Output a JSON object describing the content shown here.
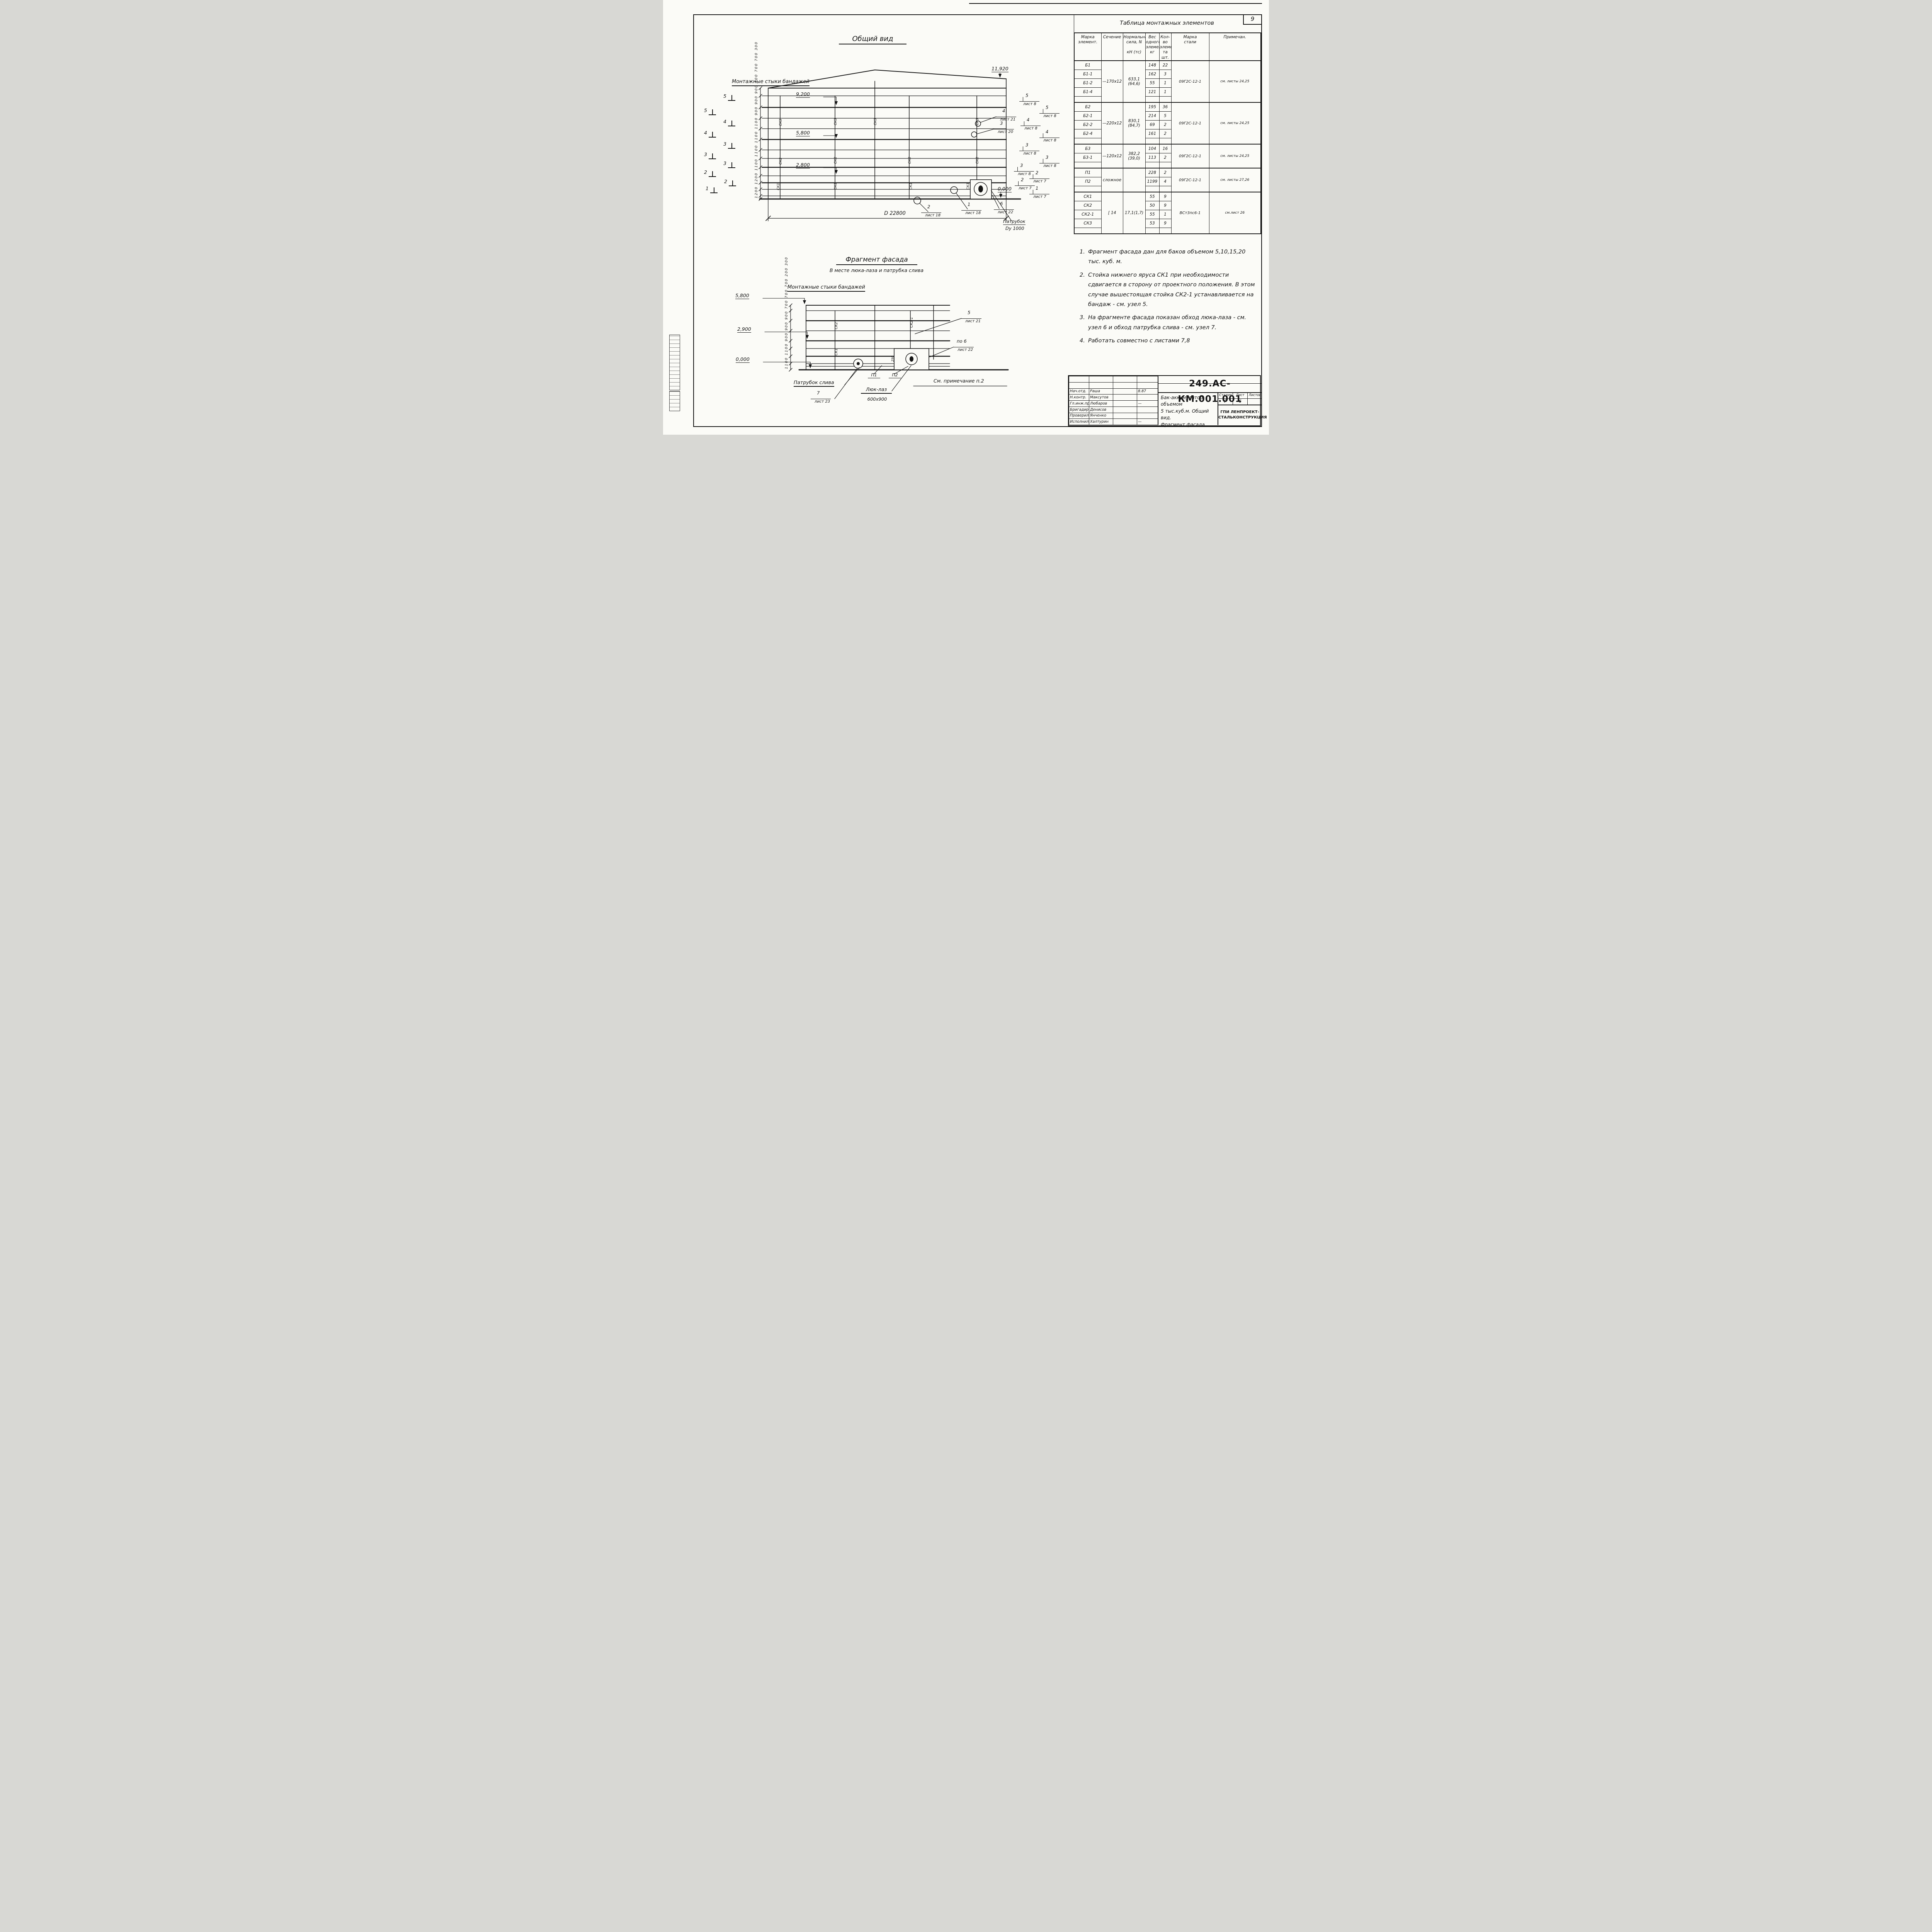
{
  "page": {
    "number": "9"
  },
  "gv": {
    "title": "Общий вид",
    "bandages": "Монтажные стыки бандажей",
    "elev_top": "11,920",
    "elev_9200": "9,200",
    "elev_5800": "5,800",
    "elev_2800": "2,800",
    "elev_0": "0,000",
    "dims_chain": "1200 1200 1100 1100 1100 1100 900 900 900 700 700 700 300",
    "sec_outer": [
      "5",
      "4",
      "3",
      "2",
      "1"
    ],
    "sec_inner": [
      "5",
      "4",
      "3",
      "3",
      "2"
    ],
    "right_marks": [
      {
        "num": "5",
        "sheet": "лист 8"
      },
      {
        "num": "5",
        "sheet": "лист 8"
      },
      {
        "num": "4",
        "sheet": "лист 8"
      },
      {
        "num": "4",
        "sheet": "лист 8"
      },
      {
        "num": "3",
        "sheet": "лист 8"
      },
      {
        "num": "3",
        "sheet": "лист 8"
      },
      {
        "num": "3",
        "sheet": "лист 8"
      },
      {
        "num": "2",
        "sheet": "лист 7"
      },
      {
        "num": "2",
        "sheet": "лист 7"
      },
      {
        "num": "1",
        "sheet": "лист 7"
      }
    ],
    "edge_callouts": [
      {
        "num": "4",
        "sheet": "лист 21"
      },
      {
        "num": "3",
        "sheet": "лист 20"
      }
    ],
    "bottom_callouts": [
      {
        "num": "2",
        "sheet": "лист 18"
      },
      {
        "num": "1",
        "sheet": "лист 18"
      },
      {
        "num": "6",
        "sheet": "лист 22"
      }
    ],
    "diameter": "D 22800",
    "patrubok_l1": "Патрубок",
    "patrubok_l2": "Dy 1000",
    "sk3": "СК3",
    "sk2": "СК2",
    "sk1": "СК1"
  },
  "fragment": {
    "title": "Фрагмент фасада",
    "subtitle": "В месте люка-лаза и патрубка слива",
    "bandages": "Монтажные стыки бандажей",
    "elev_5800": "5,800",
    "elev_2900": "2,900",
    "elev_0": "0,000",
    "dims_chain": "1100 1100 900 900 900 700 700 700 200 300",
    "sk2": "СК2",
    "sk2_1": "СК2-1",
    "sk1": "СК1",
    "dim250": "250",
    "callout_5": {
      "num": "5",
      "sheet": "лист 21"
    },
    "callout_6": {
      "num": "по 6",
      "sheet": "лист 22"
    },
    "callout_7": {
      "num": "7",
      "sheet": "лист 23"
    },
    "p1": "П1",
    "p2": "П2",
    "patrubok": "Патрубок слива",
    "luk_l1": "Люк-лаз",
    "luk_l2": "600х900",
    "note_ref": "См. примечание п.2"
  },
  "notes": {
    "items": [
      {
        "n": "1.",
        "text": "Фрагмент фасада дан для баков объемом 5,10,15,20 тыс. куб. м."
      },
      {
        "n": "2.",
        "text": "Стойка нижнего яруса СК1 при необходимости сдвигается в сторону от проектного положения. В этом случае вышестоящая стойка СК2-1 устанавливается на бандаж - см. узел 5."
      },
      {
        "n": "3.",
        "text": "На фрагменте фасада показан обход люка-лаза - см. узел 6 и обход патрубка слива - см. узел 7."
      },
      {
        "n": "4.",
        "text": "Работать совместно с листами 7,8"
      }
    ]
  },
  "table": {
    "title": "Таблица монтажных элементов",
    "headers": {
      "mark": "Марка\nэлемент.",
      "section": "Сечение",
      "force": "Нормальная\nсила, N\n\nкН (тс)",
      "weight": "Вес\nодного\nэлемент.\nкг",
      "qty": "Кол-во\nэлемен-\nта\nшт.",
      "steel": "Марка\nстали",
      "note": "Примечан."
    },
    "groups": [
      {
        "section": "—170х12",
        "force": "633,1 (64,6)",
        "steel": "09Г2С-12-1",
        "note": "см. листы 24,25",
        "rows": [
          [
            "Б1",
            "148",
            "22"
          ],
          [
            "Б1-1",
            "162",
            "3"
          ],
          [
            "Б1-2",
            "55",
            "1"
          ],
          [
            "Б1-4",
            "121",
            "1"
          ]
        ]
      },
      {
        "section": "—220х12",
        "force": "830,1 (84,7)",
        "steel": "09Г2С-12-1",
        "note": "см. листы 24,25",
        "rows": [
          [
            "Б2",
            "195",
            "36"
          ],
          [
            "Б2-1",
            "214",
            "5"
          ],
          [
            "Б2-2",
            "69",
            "2"
          ],
          [
            "Б2-4",
            "161",
            "2"
          ]
        ]
      },
      {
        "section": "—120х12",
        "force": "382,2 (39,0)",
        "steel": "09Г2С-12-1",
        "note": "см. листы 24,25",
        "rows": [
          [
            "Б3",
            "104",
            "16"
          ],
          [
            "Б3-1",
            "113",
            "2"
          ]
        ]
      },
      {
        "section": "сложное",
        "force": "",
        "steel": "09Г2С-12-1",
        "note": "см. листы 27,26",
        "rows": [
          [
            "П1",
            "228",
            "2"
          ],
          [
            "П2",
            "1199",
            "4"
          ]
        ]
      },
      {
        "section": "[ 14",
        "force": "17,1(1,7)",
        "steel": "ВСт3пс6-1",
        "note": "см.лист 26",
        "rows": [
          [
            "СК1",
            "55",
            "9"
          ],
          [
            "СК2",
            "50",
            "9"
          ],
          [
            "СК2-1",
            "55",
            "1"
          ],
          [
            "СК3",
            "53",
            "9"
          ]
        ]
      }
    ]
  },
  "title_block": {
    "doc_number": "249.АС-КМ.001.001",
    "desc_l1": "Бак-аккумулятор объемом",
    "desc_l2": "5 тыс.куб.м. Общий вид.",
    "desc_l3": "Фрагмент фасада",
    "stage_label": "Стадия",
    "sheet_label": "Лист",
    "sheets_label": "Листов",
    "stage": "Р",
    "sheet": "6",
    "sheets": "",
    "org_l1": "ГПИ ЛЕНПРОЕКТ-",
    "org_l2": "СТАЛЬКОНСТРУКЦИЯ",
    "rows": [
      {
        "role": "Нач.отд.",
        "name": "Раша",
        "date": "8.87"
      },
      {
        "role": "Н.контр.",
        "name": "Максутов",
        "date": ""
      },
      {
        "role": "Гл.инж.пр",
        "name": "Любаров",
        "date": "—"
      },
      {
        "role": "Бригадир",
        "name": "Денисов",
        "date": ""
      },
      {
        "role": "Проверил",
        "name": "Янченко",
        "date": ""
      },
      {
        "role": "Исполнил",
        "name": "Халтурин",
        "date": "—"
      }
    ]
  }
}
